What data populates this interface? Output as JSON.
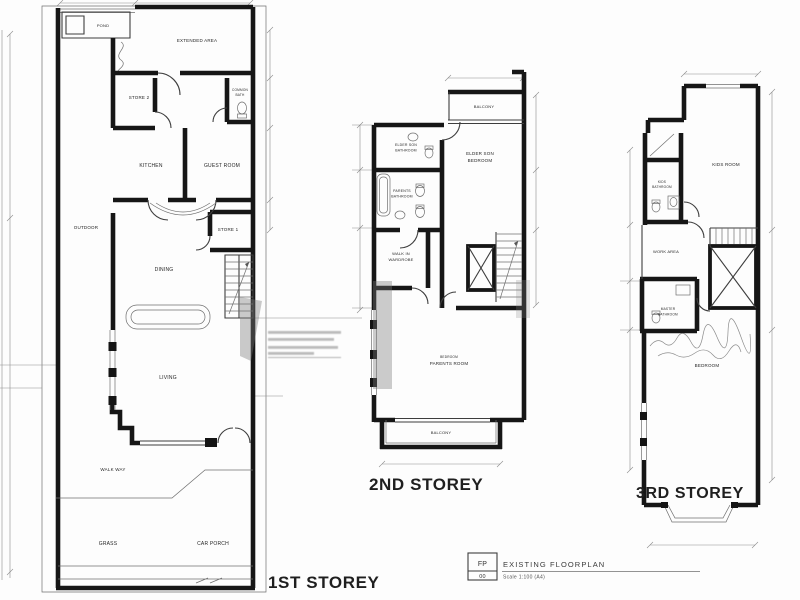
{
  "titles": {
    "storey1": "1ST STOREY",
    "storey2": "2ND STOREY",
    "storey3": "3RD STOREY"
  },
  "title_block": {
    "drawing_code": "FP",
    "drawing_number": "00",
    "drawing_title": "EXISTING FLOORPLAN",
    "scale_note": "Scale 1:100 (A4)"
  },
  "storey1": {
    "pond": "POND",
    "extended_area": "EXTENDED AREA",
    "store2": "STORE 2",
    "common_bath_l1": "COMMON",
    "common_bath_l2": "BATH",
    "kitchen": "KITCHEN",
    "guest_room": "GUEST ROOM",
    "outdoor": "OUTDOOR",
    "store1": "STORE 1",
    "dining": "DINING",
    "living": "LIVING",
    "walkway": "WALK WAY",
    "grass": "GRASS",
    "car_porch": "CAR PORCH"
  },
  "storey2": {
    "balcony_top": "BALCONY",
    "elder_son_bath_l1": "ELDER SON",
    "elder_son_bath_l2": "BATHROOM",
    "elder_son_bed_l1": "ELDER SON",
    "elder_son_bed_l2": "BEDROOM",
    "parents_bath_l1": "PARENTS",
    "parents_bath_l2": "BATHROOM",
    "wardrobe_l1": "WALK IN",
    "wardrobe_l2": "WARDROBE",
    "parents_room_l1": "BEDROOM",
    "parents_room_l2": "PARENTS ROOM",
    "balcony_bottom": "BALCONY"
  },
  "storey3": {
    "kids_room": "KIDS ROOM",
    "kids_bath_l1": "KIDS",
    "kids_bath_l2": "BATHROOM",
    "work_area": "WORK AREA",
    "master_bath_l1": "MASTER",
    "master_bath_l2": "BATHROOM",
    "bedroom": "BEDROOM"
  },
  "colors": {
    "wall": "#161616",
    "thin_line": "#6f6f6f",
    "dimension_line": "#8d8d8d",
    "label_text": "#262626",
    "watermark": "#7a7a7a",
    "background": "#fdfdfd"
  }
}
